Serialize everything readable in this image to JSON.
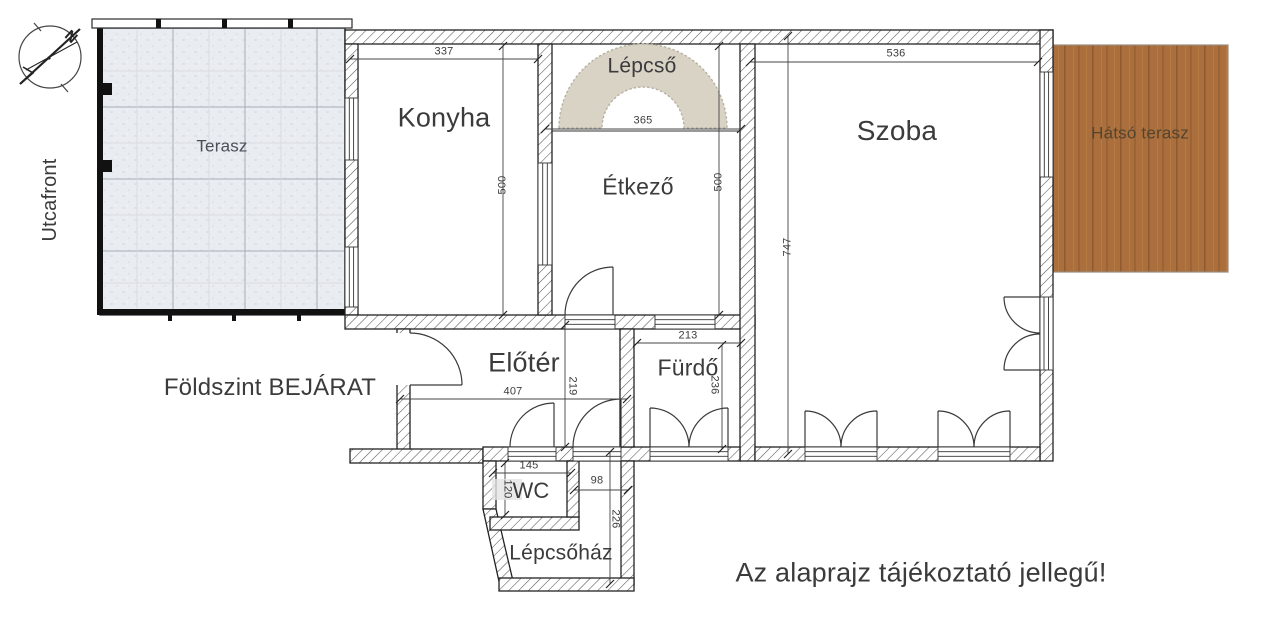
{
  "labels": {
    "street_front": "Utcafront",
    "floor_entrance": "Földszint BEJÁRAT",
    "disclaimer": "Az alaprajz tájékoztató jellegű!",
    "compass_n": "N"
  },
  "rooms": {
    "terasz": "Terasz",
    "konyha": "Konyha",
    "lepcso": "Lépcső",
    "etkezo": "Étkező",
    "szoba": "Szoba",
    "hatso_terasz": "Hátsó terasz",
    "eloter": "Előtér",
    "furdo": "Fürdő",
    "wc": "WC",
    "lepcsohaz": "Lépcsőház"
  },
  "dimensions": {
    "konyha_width": "337",
    "konyha_depth": "500",
    "lepcso_width": "365",
    "etkezo_depth": "500",
    "szoba_width": "536",
    "szoba_depth": "747",
    "eloter_width": "407",
    "eloter_depth": "219",
    "furdo_width": "213",
    "furdo_depth": "236",
    "wc_width": "145",
    "wc_depth": "120",
    "corridor_width": "98",
    "lepcsohaz_depth": "226"
  },
  "colors": {
    "terrace_fill": "#e9ecf0",
    "terrace_grid": "#a6adb9",
    "stairs_fill": "#d9d3c6",
    "wood_deck": "#aa6f3d",
    "wall_line": "#2b2b2b",
    "text": "#3b3b3b"
  }
}
